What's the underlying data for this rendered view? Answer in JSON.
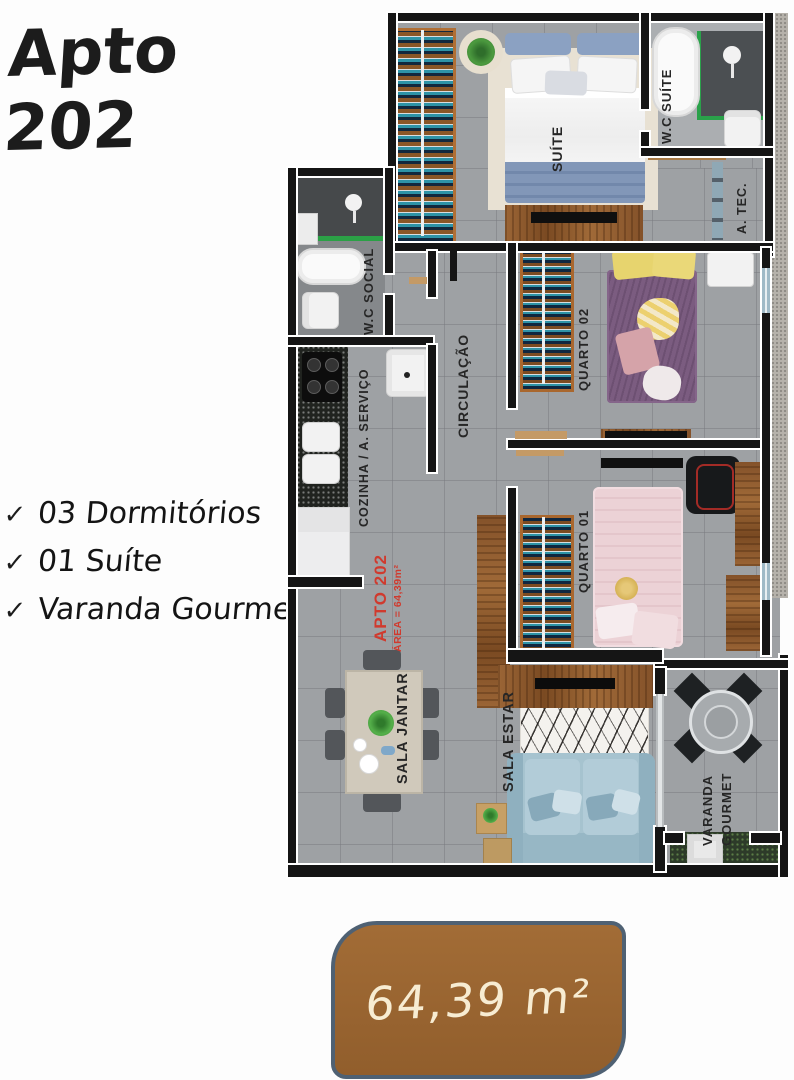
{
  "title": "Apto 202",
  "features": {
    "check": "✓",
    "items": [
      "03 Dormitórios",
      "01 Suíte",
      "Varanda Gourmet"
    ]
  },
  "plan": {
    "rooms": {
      "suite": "SUÍTE",
      "wc_suite": "W.C SUÍTE",
      "a_tec": "A. TEC.",
      "quarto02": "QUARTO 02",
      "quarto01": "QUARTO 01",
      "circulacao": "CIRCULAÇÃO",
      "wc_social": "W.C SOCIAL",
      "cozinha": "COZINHA / A. SERVIÇO",
      "sala_jantar": "SALA JANTAR",
      "sala_estar": "SALA ESTAR",
      "varanda_gourmet": "VARANDA GOURMET"
    },
    "unit_label": {
      "line1": "APTO 202",
      "line2": "ÁREA = 64,39m²"
    }
  },
  "badge": {
    "area": "64,39 m²"
  },
  "colors": {
    "accent_red": "#d03a2e",
    "badge_brown": "#9a6531",
    "badge_border": "#4f6173",
    "wall_black": "#151515",
    "floor_gray": "#9ea1a4",
    "wood": "#99662f",
    "books_teal": "#2e93a7",
    "bed_suite_blue": "#8297b8",
    "bed_q02_purple": "#7b5c80",
    "bed_q01_pink": "#ecd2d6",
    "sofa_blue": "#a6c3cf",
    "shower_green": "#2aa14a"
  }
}
